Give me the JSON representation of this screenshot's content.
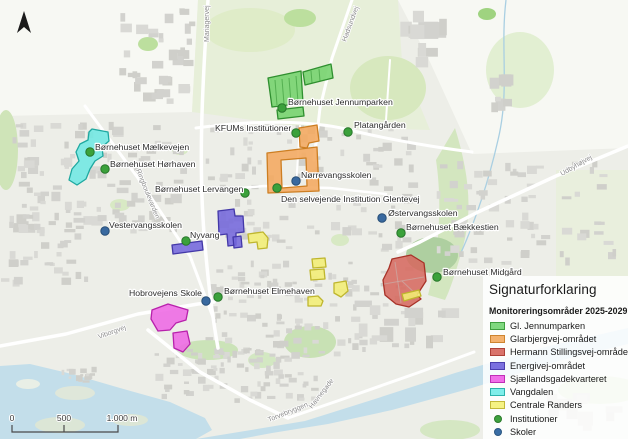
{
  "legend": {
    "title": "Signaturforklaring",
    "subtitle": "Monitoreringsområder 2025-2029",
    "items": [
      {
        "label": "Gl. Jennumparken",
        "shape": "rect",
        "fill": "#7fd87f",
        "stroke": "#3f9e3f"
      },
      {
        "label": "Glarbjergvej-området",
        "shape": "rect",
        "fill": "#f4b26e",
        "stroke": "#cd8430"
      },
      {
        "label": "Hermann Stillingsvej-området",
        "shape": "rect",
        "fill": "#d9736b",
        "stroke": "#ad4138"
      },
      {
        "label": "Energivej-området",
        "shape": "rect",
        "fill": "#7a70df",
        "stroke": "#4a3fae"
      },
      {
        "label": "Sjællandsgadekvarteret",
        "shape": "rect",
        "fill": "#f16ee9",
        "stroke": "#c02fb6"
      },
      {
        "label": "Vangdalen",
        "shape": "rect",
        "fill": "#7feeea",
        "stroke": "#2cb3ac"
      },
      {
        "label": "Centrale Randers",
        "shape": "rect",
        "fill": "#f5f283",
        "stroke": "#c3b93a"
      },
      {
        "label": "Institutioner",
        "shape": "dot",
        "fill": "#3ea23e",
        "stroke": "#2c7a2c"
      },
      {
        "label": "Skoler",
        "shape": "dot",
        "fill": "#3a6ea5",
        "stroke": "#2a5680"
      }
    ]
  },
  "scalebar": {
    "start": "0",
    "mid": "500",
    "end": "1.000 m"
  },
  "marker_colors": {
    "institution": {
      "fill": "#3ba13b",
      "stroke": "#27762a"
    },
    "school": {
      "fill": "#39699f",
      "stroke": "#274e77"
    }
  },
  "markers": [
    {
      "label": "Børnehuset Jennumparken",
      "type": "institution",
      "dot": [
        282,
        108
      ],
      "text": [
        288,
        105
      ],
      "anchor": "start"
    },
    {
      "label": "KFUMs Institutioner",
      "type": "institution",
      "dot": [
        296,
        133
      ],
      "text": [
        215,
        131
      ],
      "anchor": "start"
    },
    {
      "label": "Platangården",
      "type": "institution",
      "dot": [
        348,
        132
      ],
      "text": [
        354,
        128
      ],
      "anchor": "start"
    },
    {
      "label": "Nørrevangsskolen",
      "type": "school",
      "dot": [
        296,
        181
      ],
      "text": [
        301,
        178
      ],
      "anchor": "start"
    },
    {
      "label": "Børnehuset Lervangen",
      "type": "institution",
      "dot": [
        245,
        193
      ],
      "text": [
        155,
        192
      ],
      "anchor": "start"
    },
    {
      "label": "Den selvejende Institution Glentevej",
      "type": "institution",
      "dot": [
        277,
        188
      ],
      "text": [
        281,
        202
      ],
      "anchor": "start"
    },
    {
      "label": "Børnehuset Mælkevejen",
      "type": "institution",
      "dot": [
        90,
        152
      ],
      "text": [
        95,
        150
      ],
      "anchor": "start"
    },
    {
      "label": "Børnehuset Hørhaven",
      "type": "institution",
      "dot": [
        105,
        169
      ],
      "text": [
        110,
        167
      ],
      "anchor": "start"
    },
    {
      "label": "Vestervangsskolen",
      "type": "school",
      "dot": [
        105,
        231
      ],
      "text": [
        109,
        228
      ],
      "anchor": "start"
    },
    {
      "label": "Nyvang",
      "type": "institution",
      "dot": [
        186,
        241
      ],
      "text": [
        190,
        238
      ],
      "anchor": "start"
    },
    {
      "label": "Østervangsskolen",
      "type": "school",
      "dot": [
        382,
        218
      ],
      "text": [
        388,
        216
      ],
      "anchor": "start"
    },
    {
      "label": "Børnehuset Bækkestien",
      "type": "institution",
      "dot": [
        401,
        233
      ],
      "text": [
        406,
        230
      ],
      "anchor": "start"
    },
    {
      "label": "Børnehuset Midgård",
      "type": "institution",
      "dot": [
        437,
        277
      ],
      "text": [
        443,
        275
      ],
      "anchor": "start"
    },
    {
      "label": "Hobrovejens Skole",
      "type": "school",
      "dot": [
        206,
        301
      ],
      "text": [
        129,
        296
      ],
      "anchor": "start"
    },
    {
      "label": "Børnehuset Elmehaven",
      "type": "institution",
      "dot": [
        218,
        297
      ],
      "text": [
        224,
        294
      ],
      "anchor": "start"
    }
  ],
  "road_labels": [
    {
      "text": "Mariagervej",
      "x": 209,
      "y": 42,
      "rotate": -90
    },
    {
      "text": "Hadsundvej",
      "x": 346,
      "y": 42,
      "rotate": -70
    },
    {
      "text": "Udbyhøjvej",
      "x": 562,
      "y": 176,
      "rotate": -30
    },
    {
      "text": "Ringboulevarden",
      "x": 136,
      "y": 170,
      "rotate": 68
    },
    {
      "text": "Viborgvej",
      "x": 99,
      "y": 339,
      "rotate": -20
    },
    {
      "text": "Torvebryggen",
      "x": 269,
      "y": 422,
      "rotate": -22
    },
    {
      "text": "Havnegade",
      "x": 312,
      "y": 409,
      "rotate": -52
    }
  ],
  "areas": [
    {
      "name": "gl-jennumparken",
      "fill": "#74d36c",
      "stroke": "#2f8f2f",
      "polys": [
        "268,78 301,71 303,103 272,107",
        "303,72 331,64 333,78 305,85",
        "277,110 303,107 304,116 278,119"
      ],
      "lines": [
        [
          275,
          80,
          277,
          105
        ],
        [
          282,
          79,
          284,
          104
        ],
        [
          289,
          78,
          291,
          103
        ],
        [
          296,
          76,
          298,
          102
        ],
        [
          311,
          71,
          312,
          83
        ],
        [
          319,
          69,
          320,
          81
        ]
      ]
    },
    {
      "name": "glarbjergvej-omraadet",
      "fill": "#f4a95e",
      "stroke": "#cd7e22",
      "polys": [
        "299,128 317,125 319,141 309,143 307,148 300,147"
      ],
      "paths": [
        "M267,153 L317,147 L319,191 L268,193 Z M281,160 L306,158 L307,186 L282,188 Z"
      ]
    },
    {
      "name": "hermann-stillingsvej-omraadet",
      "fill": "#d66a60",
      "stroke": "#a83228",
      "polys": [
        "392,259 411,255 424,263 426,281 417,295 421,299 409,307 396,304 385,295 383,280 389,268"
      ],
      "lines": [
        [
          395,
          262,
          401,
          303
        ],
        [
          384,
          284,
          424,
          277
        ],
        [
          402,
          281,
          418,
          296
        ]
      ],
      "line_color": "#c7bab6"
    },
    {
      "name": "energivej-omraadet",
      "fill": "#7468dc",
      "stroke": "#4338a8",
      "polys": [
        "218,211 234,209 235,216 243,216 244,232 236,233 236,245 228,246 227,234 219,235",
        "233,237 241,236 242,247 234,248",
        "172,245 202,241 203,250 173,254"
      ]
    },
    {
      "name": "sjaellandsgadekvarteret",
      "fill": "#ee69e4",
      "stroke": "#b821ac",
      "polys": [
        "152,310 168,304 188,310 186,320 176,323 170,330 158,331 151,319",
        "173,333 187,331 190,344 183,352 174,348"
      ]
    },
    {
      "name": "vangdalen",
      "fill": "#6fe8e2",
      "stroke": "#1fa8a0",
      "polys": [
        "92,129 108,132 109,141 102,147 103,156 95,161 90,169 86,179 77,185 69,180 72,169 79,161 76,152 80,144 88,140 89,132"
      ]
    },
    {
      "name": "centrale-randers",
      "fill": "#f2ee74",
      "stroke": "#bfb62e",
      "polys": [
        "312,259 325,258 326,267 313,268",
        "310,270 324,269 325,279 311,280",
        "334,283 346,281 348,291 341,297 334,293",
        "308,297 318,296 323,301 321,306 308,306",
        "248,234 263,232 268,238 267,248 258,249 257,242 249,243",
        "402,294 419,290 421,296 404,301"
      ]
    }
  ]
}
